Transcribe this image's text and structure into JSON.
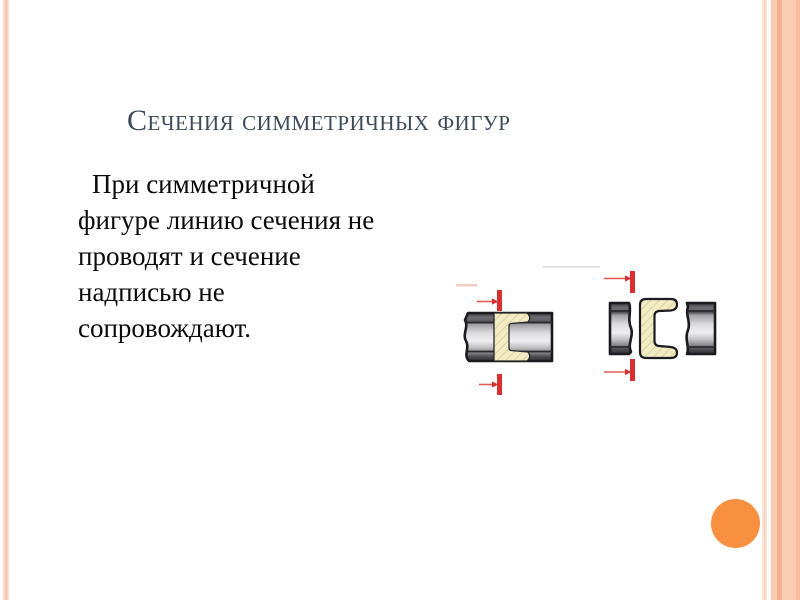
{
  "slide": {
    "title": "Сечения симметричных фигур",
    "body_text": "При симметричной фигуре линию сечения не проводят и сечение надписью не сопровождают.",
    "colors": {
      "title_text": "#3e4a5a",
      "body_text": "#0b0b0b",
      "accent_circle_orange": "#f89040",
      "border_stripe_peach": "#f6c5ad",
      "border_band_peach": "#fbceb4",
      "border_band_dark_peach": "#f5b091",
      "cutting_plane_red": "#d7302e",
      "section_fill_cream": "#f2ecc4",
      "section_hatch": "#d8cc96",
      "metal_outline": "#1b1b1f"
    },
    "figures": {
      "left_figure_name": "superimposed-section-view",
      "right_figure_name": "section-in-break-view"
    }
  }
}
